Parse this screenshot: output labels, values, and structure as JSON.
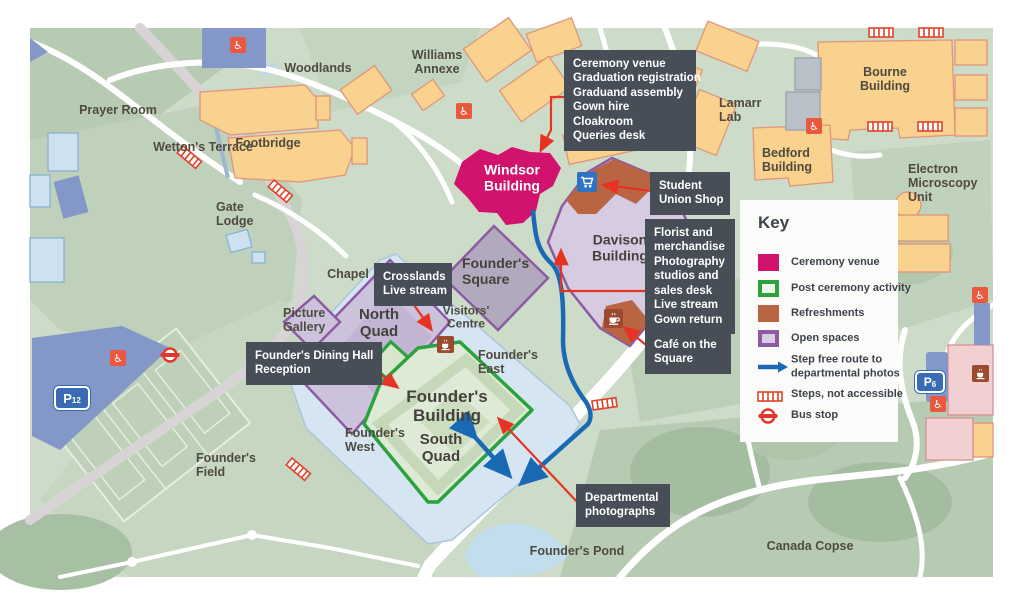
{
  "labels": {
    "woodlands": {
      "lines": [
        "Woodlands"
      ]
    },
    "prayer_room": {
      "lines": [
        "Prayer Room"
      ]
    },
    "wettons_terrace": {
      "lines": [
        "Wetton's Terrace"
      ]
    },
    "footbridge": {
      "lines": [
        "Footbridge"
      ]
    },
    "gate_lodge": {
      "lines": [
        "Gate",
        "Lodge"
      ]
    },
    "williams_annexe": {
      "lines": [
        "Williams",
        "Annexe"
      ]
    },
    "lamarr_lab": {
      "lines": [
        "Lamarr",
        "Lab"
      ]
    },
    "bourne_building": {
      "lines": [
        "Bourne",
        "Building"
      ]
    },
    "bedford_building": {
      "lines": [
        "Bedford",
        "Building"
      ]
    },
    "electron_microscopy": {
      "lines": [
        "Electron",
        "Microscopy",
        "Unit"
      ]
    },
    "windsor_building": {
      "lines": [
        "Windsor",
        "Building"
      ]
    },
    "davison_building": {
      "lines": [
        "Davison",
        "Building"
      ]
    },
    "founders_square": {
      "lines": [
        "Founder's",
        "Square"
      ]
    },
    "chapel": {
      "lines": [
        "Chapel"
      ]
    },
    "picture_gallery": {
      "lines": [
        "Picture",
        "Gallery"
      ]
    },
    "north_quad": {
      "lines": [
        "North",
        "Quad"
      ]
    },
    "visitors_centre": {
      "lines": [
        "Visitors'",
        "Centre"
      ]
    },
    "founders_east": {
      "lines": [
        "Founder's",
        "East"
      ]
    },
    "founders_building": {
      "lines": [
        "Founder's",
        "Building"
      ]
    },
    "south_quad": {
      "lines": [
        "South",
        "Quad"
      ]
    },
    "founders_west": {
      "lines": [
        "Founder's",
        "West"
      ]
    },
    "founders_field": {
      "lines": [
        "Founder's",
        "Field"
      ]
    },
    "founders_pond": {
      "lines": [
        "Founder's Pond"
      ]
    },
    "canada_copse": {
      "lines": [
        "Canada Copse"
      ]
    }
  },
  "callouts": {
    "ceremony": {
      "lines": [
        "Ceremony venue",
        "Graduation registration",
        "Graduand assembly",
        "Gown hire",
        "Cloakroom",
        "Queries desk"
      ]
    },
    "student_union": {
      "lines": [
        "Student",
        "Union Shop"
      ]
    },
    "florist": {
      "lines": [
        "Florist and",
        "merchandise",
        "Photography",
        "studios and",
        "sales desk",
        "Live stream",
        "Gown return"
      ]
    },
    "cafe_square": {
      "lines": [
        "Café on the",
        "Square"
      ]
    },
    "crosslands": {
      "lines": [
        "Crosslands",
        "Live stream"
      ]
    },
    "dining": {
      "lines": [
        "Founder's Dining Hall",
        "Reception"
      ]
    },
    "departmental": {
      "lines": [
        "Departmental",
        "photographs"
      ]
    }
  },
  "key": {
    "title": "Key",
    "ceremony": "Ceremony venue",
    "post_ceremony": "Post ceremony activity",
    "refreshments": "Refreshments",
    "open_spaces": "Open spaces",
    "step_free": {
      "lines": [
        "Step free route to",
        "departmental photos"
      ]
    },
    "steps": "Steps, not accessible",
    "bus": "Bus stop"
  },
  "parking": {
    "p12": {
      "letter": "P",
      "number": "12"
    },
    "p6": {
      "letter": "P",
      "number": "6"
    }
  },
  "colors": {
    "ceremony_pink": "#d2136d",
    "post_ceremony_green": "#2ba23c",
    "refreshments_brown": "#b96544",
    "open_spaces_purple": "#8e5ba3",
    "route_blue": "#1a69b5",
    "arrow_red": "#e63323",
    "callout_slate": "#474e58"
  }
}
